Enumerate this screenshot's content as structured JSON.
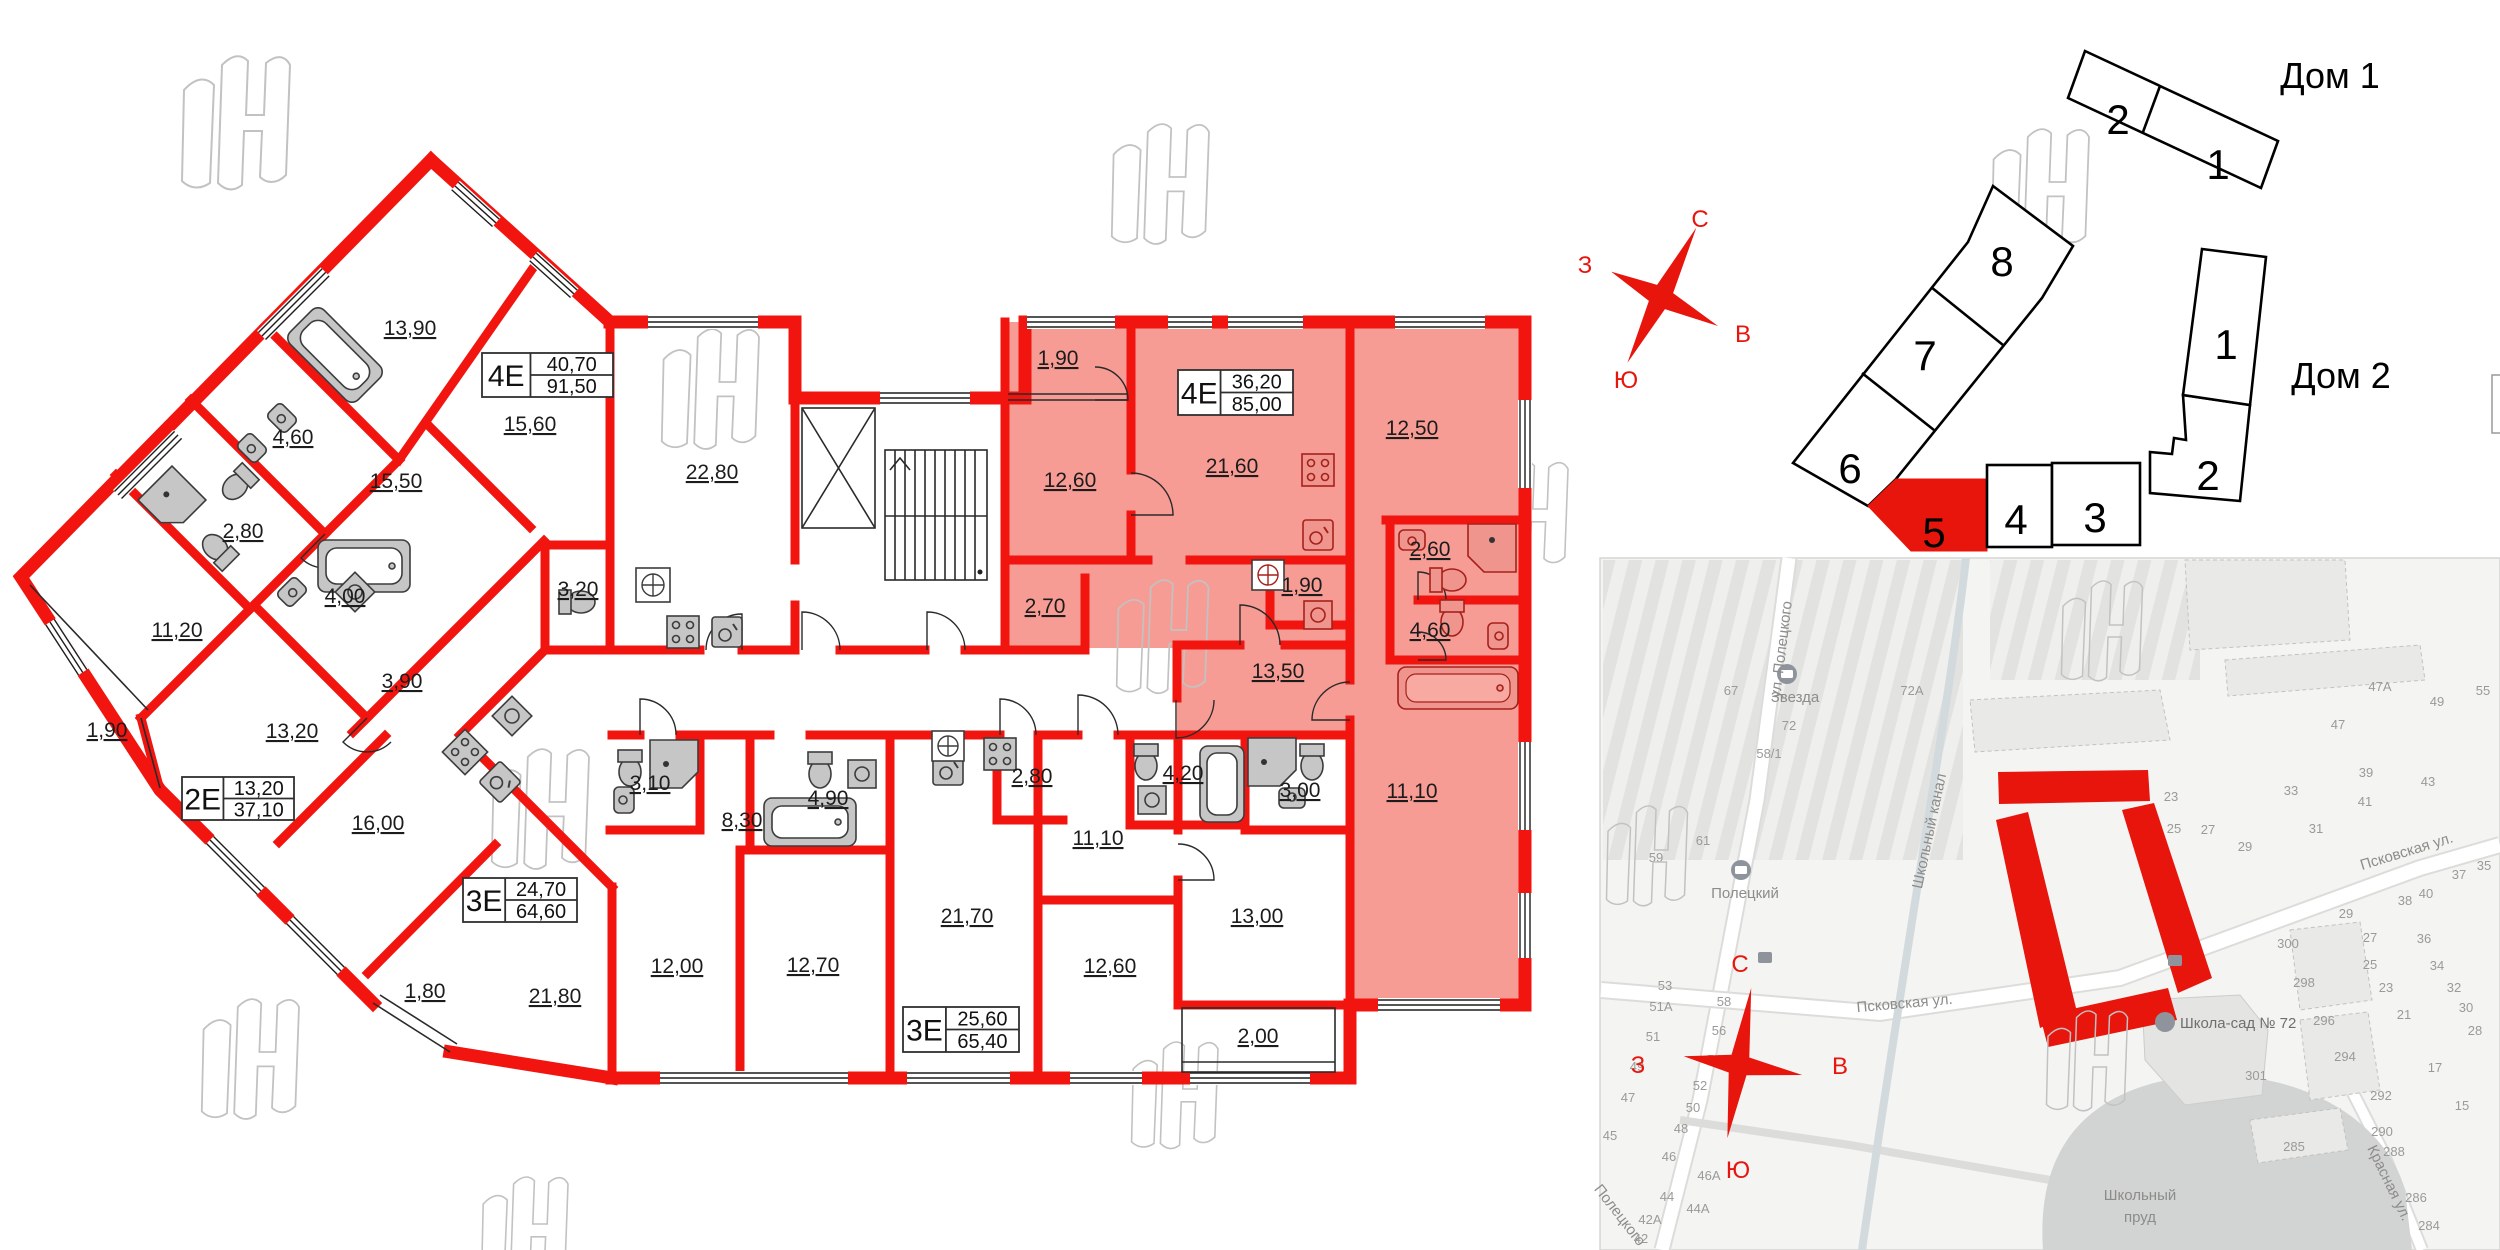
{
  "title_labels": {
    "house1": "Дом 1",
    "house2": "Дом 2"
  },
  "compass": {
    "n": "С",
    "e": "В",
    "s": "Ю",
    "w": "З"
  },
  "floor_plan": {
    "wall_color": "#f2150f",
    "highlight_color": "#f79c95",
    "room_labels": [
      {
        "t": "13,90",
        "x": 410,
        "y": 335
      },
      {
        "t": "15,60",
        "x": 530,
        "y": 431
      },
      {
        "t": "4,60",
        "x": 293,
        "y": 444
      },
      {
        "t": "15,50",
        "x": 396,
        "y": 488
      },
      {
        "t": "2,80",
        "x": 243,
        "y": 538
      },
      {
        "t": "22,80",
        "x": 712,
        "y": 479
      },
      {
        "t": "3,20",
        "x": 578,
        "y": 596
      },
      {
        "t": "4,00",
        "x": 345,
        "y": 603
      },
      {
        "t": "11,20",
        "x": 177,
        "y": 637
      },
      {
        "t": "3,90",
        "x": 402,
        "y": 688
      },
      {
        "t": "1,90",
        "x": 107,
        "y": 737
      },
      {
        "t": "13,20",
        "x": 292,
        "y": 738
      },
      {
        "t": "16,00",
        "x": 378,
        "y": 830
      },
      {
        "t": "3,10",
        "x": 650,
        "y": 790
      },
      {
        "t": "8,30",
        "x": 742,
        "y": 827
      },
      {
        "t": "4,90",
        "x": 828,
        "y": 805
      },
      {
        "t": "1,80",
        "x": 425,
        "y": 998
      },
      {
        "t": "21,80",
        "x": 555,
        "y": 1003
      },
      {
        "t": "12,00",
        "x": 677,
        "y": 973
      },
      {
        "t": "12,70",
        "x": 813,
        "y": 972
      },
      {
        "t": "21,70",
        "x": 967,
        "y": 923
      },
      {
        "t": "2,80",
        "x": 1032,
        "y": 783
      },
      {
        "t": "11,10",
        "x": 1098,
        "y": 845
      },
      {
        "t": "4,20",
        "x": 1183,
        "y": 780
      },
      {
        "t": "3,00",
        "x": 1300,
        "y": 797
      },
      {
        "t": "13,00",
        "x": 1257,
        "y": 923
      },
      {
        "t": "12,60",
        "x": 1110,
        "y": 973
      },
      {
        "t": "2,00",
        "x": 1258,
        "y": 1043
      },
      {
        "t": "1,90",
        "x": 1058,
        "y": 365
      },
      {
        "t": "12,60",
        "x": 1070,
        "y": 487
      },
      {
        "t": "2,70",
        "x": 1045,
        "y": 613
      },
      {
        "t": "21,60",
        "x": 1232,
        "y": 473
      },
      {
        "t": "12,50",
        "x": 1412,
        "y": 435
      },
      {
        "t": "2,60",
        "x": 1430,
        "y": 556
      },
      {
        "t": "1,90",
        "x": 1302,
        "y": 592
      },
      {
        "t": "4,60",
        "x": 1430,
        "y": 637
      },
      {
        "t": "13,50",
        "x": 1278,
        "y": 678
      },
      {
        "t": "11,10",
        "x": 1412,
        "y": 798
      }
    ],
    "info_boxes": [
      {
        "type": "4Е",
        "area1": "40,70",
        "area2": "91,50",
        "x": 482,
        "y": 353,
        "w": 131,
        "h": 44
      },
      {
        "type": "2Е",
        "area1": "13,20",
        "area2": "37,10",
        "x": 182,
        "y": 777,
        "w": 112,
        "h": 43
      },
      {
        "type": "3Е",
        "area1": "24,70",
        "area2": "64,60",
        "x": 463,
        "y": 878,
        "w": 114,
        "h": 44
      },
      {
        "type": "3Е",
        "area1": "25,60",
        "area2": "65,40",
        "x": 903,
        "y": 1007,
        "w": 116,
        "h": 45
      },
      {
        "type": "4Е",
        "area1": "36,20",
        "area2": "85,00",
        "x": 1178,
        "y": 370,
        "w": 115,
        "h": 45
      }
    ]
  },
  "site_plan": {
    "selected_section": "5",
    "sections": [
      {
        "n": "2",
        "x": 2118,
        "y": 119,
        "selected": false
      },
      {
        "n": "1",
        "x": 2218,
        "y": 164,
        "selected": false
      },
      {
        "n": "8",
        "x": 2002,
        "y": 261,
        "selected": false
      },
      {
        "n": "7",
        "x": 1925,
        "y": 355,
        "selected": false
      },
      {
        "n": "6",
        "x": 1850,
        "y": 468,
        "selected": false
      },
      {
        "n": "5",
        "x": 1934,
        "y": 532,
        "selected": true
      },
      {
        "n": "4",
        "x": 2016,
        "y": 519,
        "selected": false
      },
      {
        "n": "3",
        "x": 2095,
        "y": 517,
        "selected": false
      },
      {
        "n": "2",
        "x": 2208,
        "y": 475,
        "selected": false
      },
      {
        "n": "1",
        "x": 2226,
        "y": 344,
        "selected": false
      }
    ]
  },
  "map": {
    "street_top": "ул. Полецкого",
    "street_pskov": "Псковская ул.",
    "street_krasnaya": "Красная ул.",
    "street_sw": "Полецкого",
    "canal": "Школьный канал",
    "stop1": "Звезда",
    "stop2": "Полецкий",
    "school": "Школа-сад № 72",
    "pond_line1": "Школьный",
    "pond_line2": "пруд",
    "numbers": [
      [
        "67",
        1731,
        695
      ],
      [
        "72",
        1789,
        730
      ],
      [
        "58/1",
        1769,
        758
      ],
      [
        "72А",
        1912,
        695
      ],
      [
        "61",
        1703,
        845
      ],
      [
        "59",
        1656,
        862
      ],
      [
        "53",
        1665,
        990
      ],
      [
        "51А",
        1661,
        1011
      ],
      [
        "51",
        1653,
        1041
      ],
      [
        "49",
        1637,
        1071
      ],
      [
        "47",
        1628,
        1102
      ],
      [
        "45",
        1610,
        1140
      ],
      [
        "58",
        1724,
        1006
      ],
      [
        "56",
        1719,
        1035
      ],
      [
        "54",
        1714,
        1064
      ],
      [
        "52",
        1700,
        1090
      ],
      [
        "50",
        1693,
        1112
      ],
      [
        "48",
        1681,
        1133
      ],
      [
        "46",
        1669,
        1161
      ],
      [
        "46А",
        1709,
        1180
      ],
      [
        "44",
        1667,
        1201
      ],
      [
        "44А",
        1698,
        1213
      ],
      [
        "42А",
        1650,
        1224
      ],
      [
        "42",
        1641,
        1243
      ],
      [
        "47А",
        2380,
        691
      ],
      [
        "49",
        2437,
        706
      ],
      [
        "55",
        2483,
        695
      ],
      [
        "47",
        2338,
        729
      ],
      [
        "39",
        2366,
        777
      ],
      [
        "41",
        2365,
        806
      ],
      [
        "43",
        2428,
        786
      ],
      [
        "23",
        2171,
        801
      ],
      [
        "25",
        2174,
        833
      ],
      [
        "27",
        2208,
        834
      ],
      [
        "29",
        2245,
        851
      ],
      [
        "31",
        2316,
        833
      ],
      [
        "33",
        2291,
        795
      ],
      [
        "37",
        2459,
        879
      ],
      [
        "35",
        2484,
        870
      ],
      [
        "38",
        2405,
        905
      ],
      [
        "40",
        2426,
        898
      ],
      [
        "300",
        2288,
        948
      ],
      [
        "298",
        2304,
        987
      ],
      [
        "296",
        2324,
        1025
      ],
      [
        "294",
        2345,
        1061
      ],
      [
        "292",
        2381,
        1100
      ],
      [
        "290",
        2382,
        1136
      ],
      [
        "288",
        2394,
        1156
      ],
      [
        "285",
        2294,
        1151
      ],
      [
        "301",
        2256,
        1080
      ],
      [
        "286",
        2416,
        1202
      ],
      [
        "284",
        2429,
        1230
      ],
      [
        "29",
        2346,
        918
      ],
      [
        "27",
        2370,
        942
      ],
      [
        "25",
        2370,
        969
      ],
      [
        "23",
        2386,
        992
      ],
      [
        "21",
        2404,
        1019
      ],
      [
        "17",
        2435,
        1072
      ],
      [
        "15",
        2462,
        1110
      ],
      [
        "36",
        2424,
        943
      ],
      [
        "34",
        2437,
        970
      ],
      [
        "32",
        2454,
        992
      ],
      [
        "30",
        2466,
        1012
      ],
      [
        "28",
        2475,
        1035
      ]
    ]
  }
}
